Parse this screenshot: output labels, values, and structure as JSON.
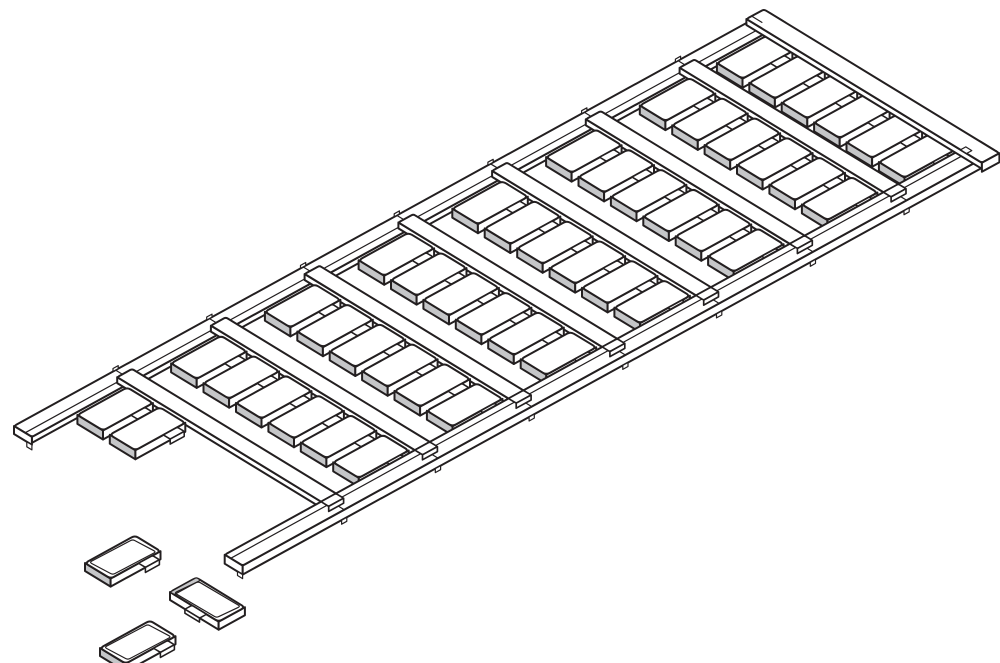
{
  "figure": {
    "kind": "isometric-technical-line-drawing",
    "subject": "marker-tag carrier strip with snap-off labels",
    "loose_tag_count": 3,
    "rows_per_column": 6,
    "full_columns": 7,
    "partial_first_column_tags": 2
  },
  "canvas": {
    "width": 1000,
    "height": 663,
    "background": "#ffffff"
  },
  "style": {
    "stroke": "#231f20",
    "fill": "#ffffff",
    "shade": "#c5c6c8",
    "stroke_main": 2,
    "stroke_detail": 1.2
  },
  "iso": {
    "origin": [
      14,
      426
    ],
    "axisA": [
      0.876,
      -0.482
    ],
    "axisB": [
      0.853,
      0.521
    ],
    "drop": 9
  },
  "strip": {
    "length": 860,
    "width": 268,
    "rail_w": 21,
    "far_lip_v": 13,
    "near_lip_v": 254,
    "rib_w": 17,
    "rib_v0": 8,
    "rib_v1": 255,
    "rib_u": [
      110,
      217,
      324,
      431,
      538,
      645,
      752
    ],
    "endcap_u": 840,
    "endcap_overhang": 4,
    "band_drop": 6
  },
  "tags": {
    "len": 57,
    "wid": 30,
    "row_v0": 24,
    "row_pitch": 38,
    "rows": 6,
    "end_gap": 4,
    "tab_a": 0.56,
    "tab_b": 0.84,
    "tab_out": 8,
    "tab_side": 5,
    "corner_r": 4
  },
  "loose_tags": [
    {
      "x": 85,
      "y": 563,
      "axis": "A"
    },
    {
      "x": 170,
      "y": 592,
      "axis": "B"
    },
    {
      "x": 100,
      "y": 648,
      "axis": "A"
    }
  ]
}
